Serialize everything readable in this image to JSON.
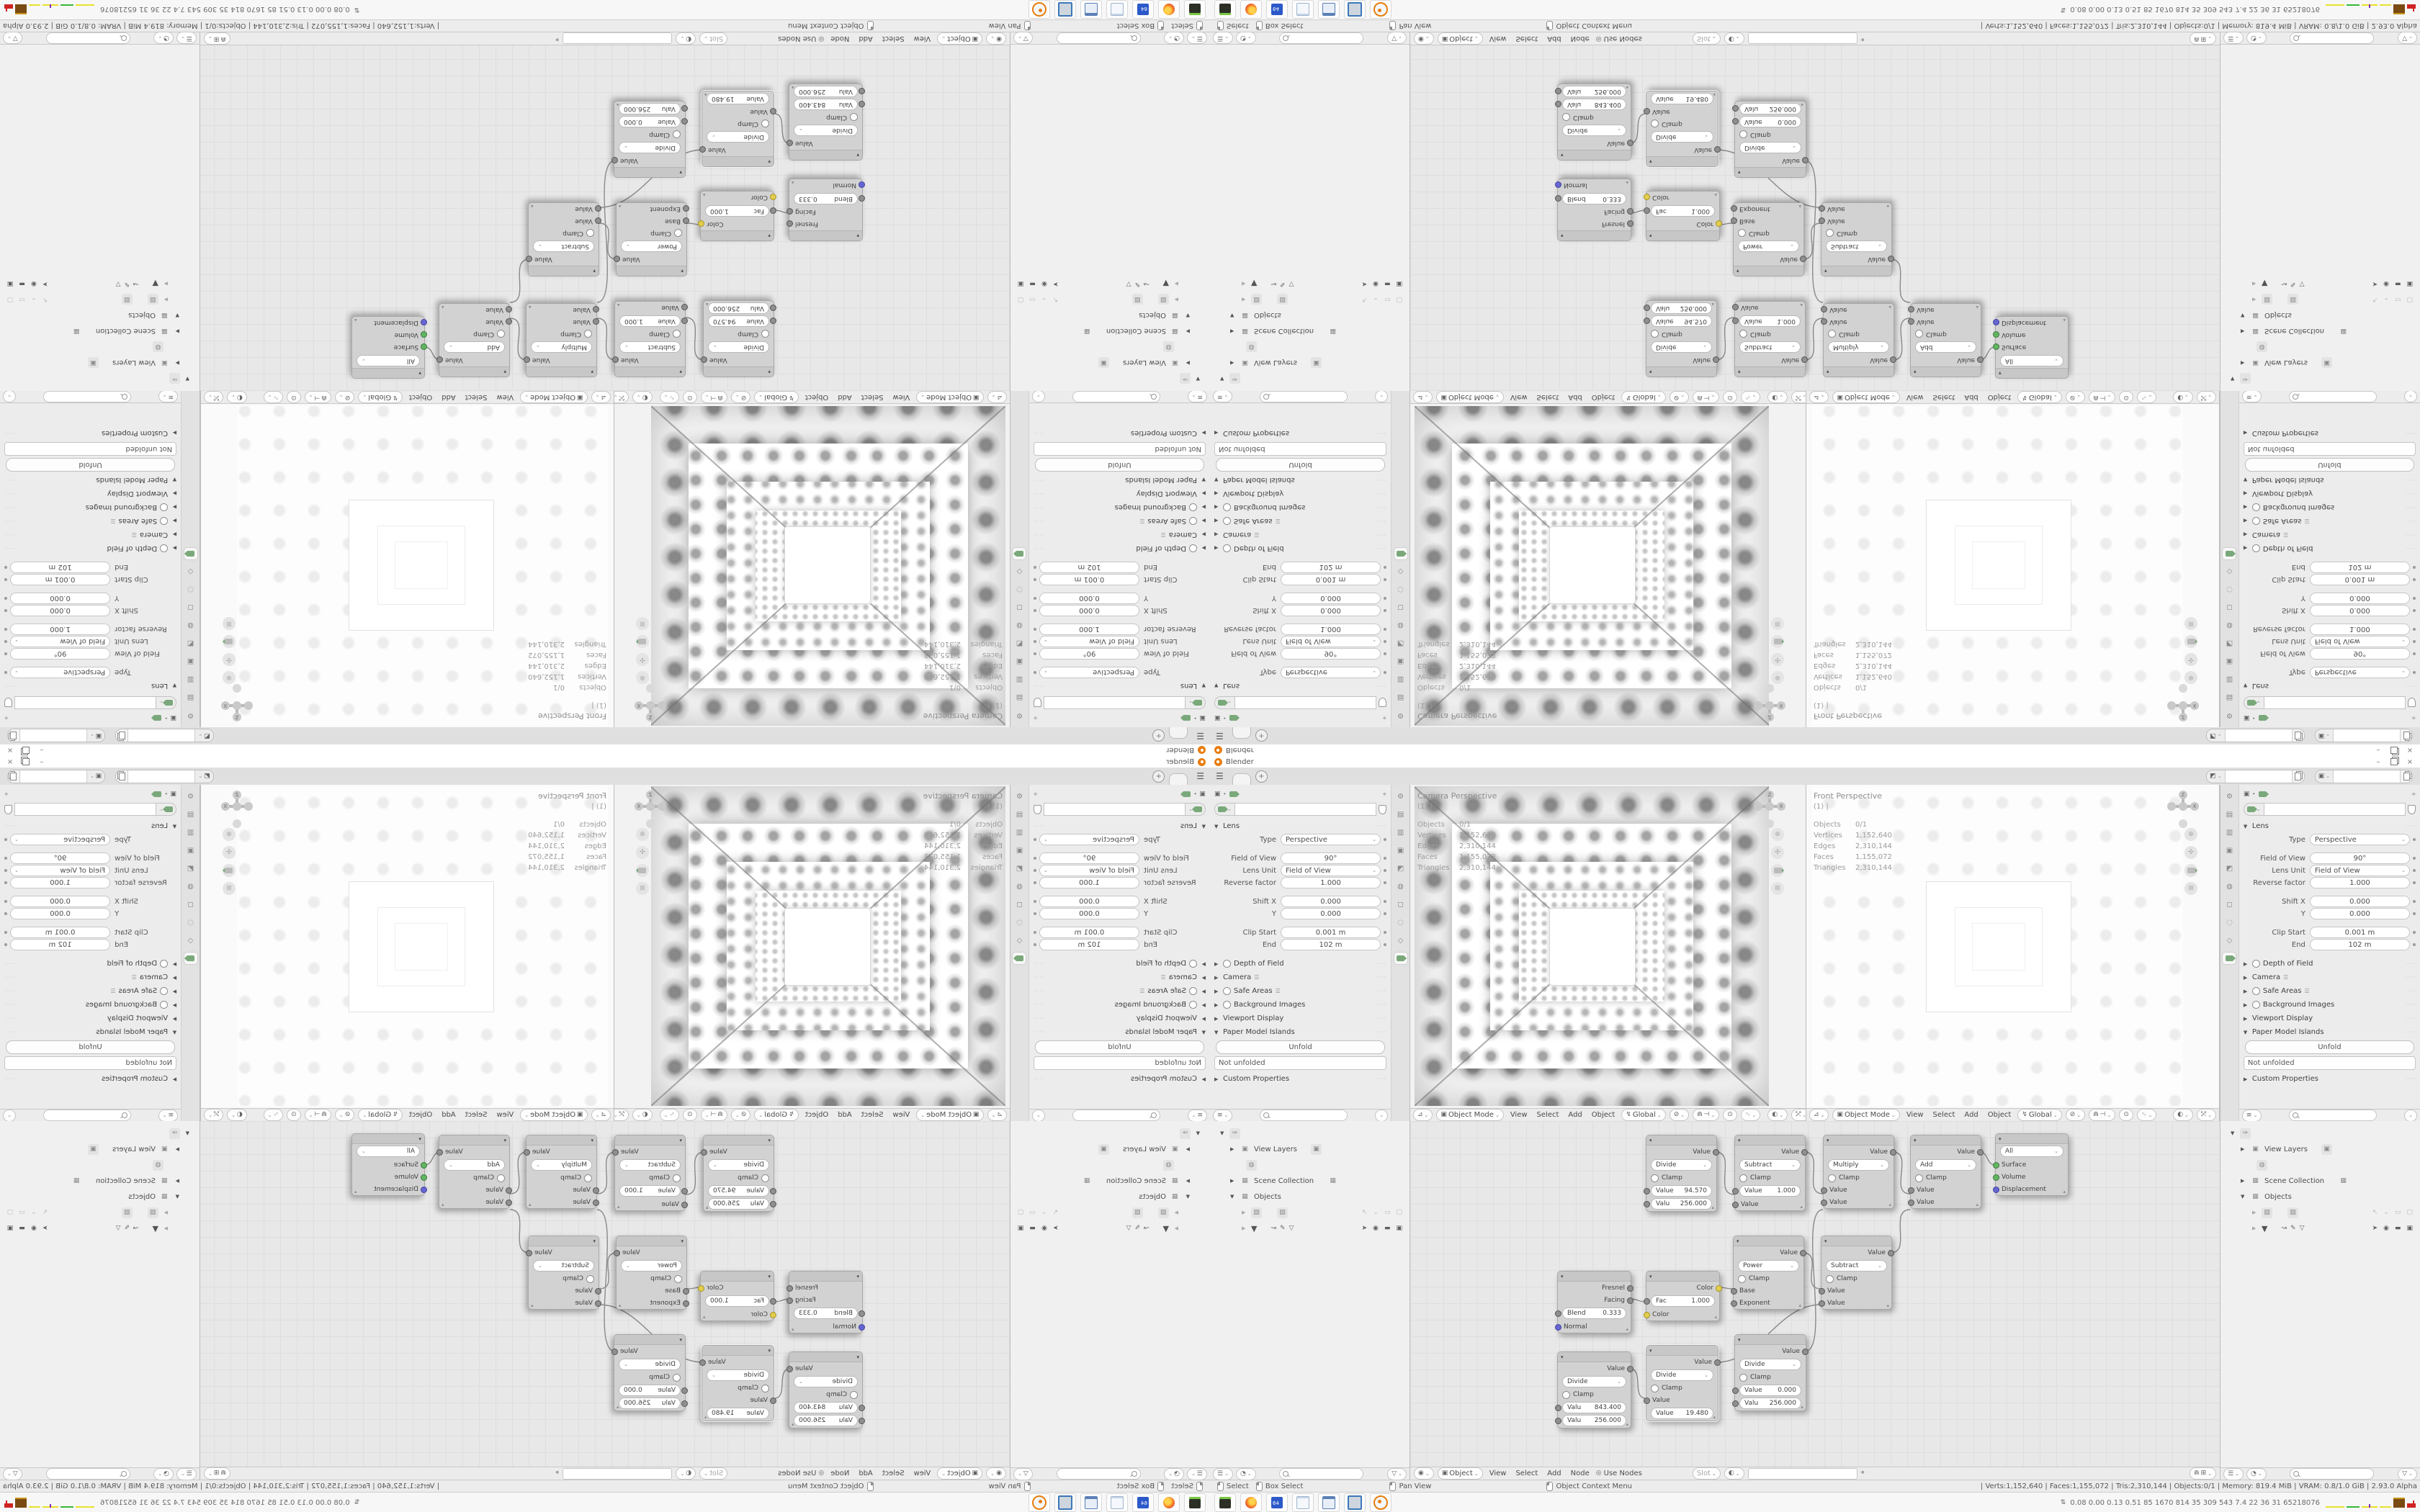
{
  "window": {
    "title": "Blender",
    "minimize": "–",
    "close": "×"
  },
  "topbar": {
    "plus_label": "+"
  },
  "viewport": {
    "header": {
      "mode": "Object Mode",
      "menus": {
        "view": "View",
        "select": "Select",
        "add": "Add",
        "object": "Object"
      },
      "orientation": "Global"
    },
    "overlay": {
      "vp1_title": "Camera Perspective",
      "vp2_title": "Front Perspective",
      "line2": "(1) |",
      "stats": [
        {
          "label": "Objects",
          "value": "0/1"
        },
        {
          "label": "Vertices",
          "value": "1,152,640"
        },
        {
          "label": "Edges",
          "value": "2,310,144"
        },
        {
          "label": "Faces",
          "value": "1,155,072"
        },
        {
          "label": "Triangles",
          "value": "2,310,144"
        }
      ]
    },
    "gizmo": {
      "z": "Z",
      "x": "X"
    }
  },
  "properties": {
    "lens_title": "Lens",
    "rows": [
      {
        "label": "Type",
        "value": "Perspective"
      },
      {
        "label": "Field of View",
        "value": "90°"
      },
      {
        "label": "Lens Unit",
        "value": "Field of View"
      },
      {
        "label": "Reverse factor",
        "value": "1.000"
      },
      {
        "label": "Shift X",
        "value": "0.000"
      },
      {
        "label": "Y",
        "value": "0.000"
      },
      {
        "label": "Clip Start",
        "value": "0.001 m"
      },
      {
        "label": "End",
        "value": "102 m"
      }
    ],
    "panels": {
      "dof": "Depth of Field",
      "camera": "Camera",
      "safe": "Safe Areas",
      "bg": "Background Images",
      "vpd": "Viewport Display",
      "pmi": "Paper Model Islands",
      "custom": "Custom Properties"
    },
    "unfold": "Unfold",
    "not_unfolded": "Not unfolded"
  },
  "outliner": {
    "view_layers": "View Layers",
    "scene_collection": "Scene Collection",
    "objects": "Objects"
  },
  "node_editor": {
    "header": {
      "target": "Object",
      "menus": {
        "view": "View",
        "select": "Select",
        "add": "Add",
        "node": "Node"
      },
      "use_nodes": "Use Nodes",
      "slot": "Slot"
    },
    "nodes": {
      "divide1": {
        "op": "Divide",
        "clamp": "Clamp",
        "out": "Value",
        "f1": {
          "l": "Value",
          "v": "94.570"
        },
        "f2": {
          "l": "Valu",
          "v": "256.000"
        }
      },
      "subtract1": {
        "op": "Subtract",
        "clamp": "Clamp",
        "out": "Value",
        "f1": {
          "l": "Value",
          "v": "1.000"
        },
        "in2": "Value"
      },
      "multiply1": {
        "op": "Multiply",
        "clamp": "Clamp",
        "out": "Value",
        "in1": "Value",
        "in2": "Value"
      },
      "add1": {
        "op": "Add",
        "clamp": "Clamp",
        "out": "Value",
        "in1": "Value",
        "in2": "Value"
      },
      "output1": {
        "target": "All",
        "in1": "Surface",
        "in2": "Volume",
        "in3": "Displacement"
      },
      "power1": {
        "op": "Power",
        "clamp": "Clamp",
        "out": "Value",
        "in1": "Base",
        "in2": "Exponent"
      },
      "subtract2": {
        "op": "Subtract",
        "clamp": "Clamp",
        "out": "Value",
        "in1": "Value",
        "in2": "Value"
      },
      "layerweight1": {
        "out1": "Fresnel",
        "out2": "Facing",
        "f1": {
          "l": "Blend",
          "v": "0.333"
        },
        "in1": "Normal"
      },
      "mix1": {
        "out": "Color",
        "f1": {
          "l": "Fac",
          "v": "1.000"
        },
        "in1": "Color"
      },
      "divide2": {
        "op": "Divide",
        "clamp": "Clamp",
        "out": "Value",
        "f1": {
          "l": "Valu",
          "v": "843.400"
        },
        "f2": {
          "l": "Valu",
          "v": "256.000"
        }
      },
      "divide3": {
        "op": "Divide",
        "clamp": "Clamp",
        "out": "Value",
        "in1": "Value",
        "f1": {
          "l": "Value",
          "v": "19.480"
        }
      },
      "divide4": {
        "op": "Divide",
        "clamp": "Clamp",
        "out": "Value",
        "f1": {
          "l": "Value",
          "v": "0.000"
        },
        "f2": {
          "l": "Valu",
          "v": "256.000"
        }
      }
    }
  },
  "status": {
    "hints": {
      "h1": "Select",
      "h2": "Box Select",
      "h3": "Pan View",
      "h4": "Object Context Menu"
    },
    "stats": "| Verts:1,152,640 | Faces:1,155,072 | Tris:2,310,144 | Objects:0/1 | Memory: 819.4 MiB | VRAM: 0.8/1.0 GiB | 2.93.0 Alpha"
  },
  "taskbar": {
    "metrics": "0.08 0.00 0.13 0.51   85   1670 814   35   309 543   7.4   22   36   31   65218076"
  }
}
